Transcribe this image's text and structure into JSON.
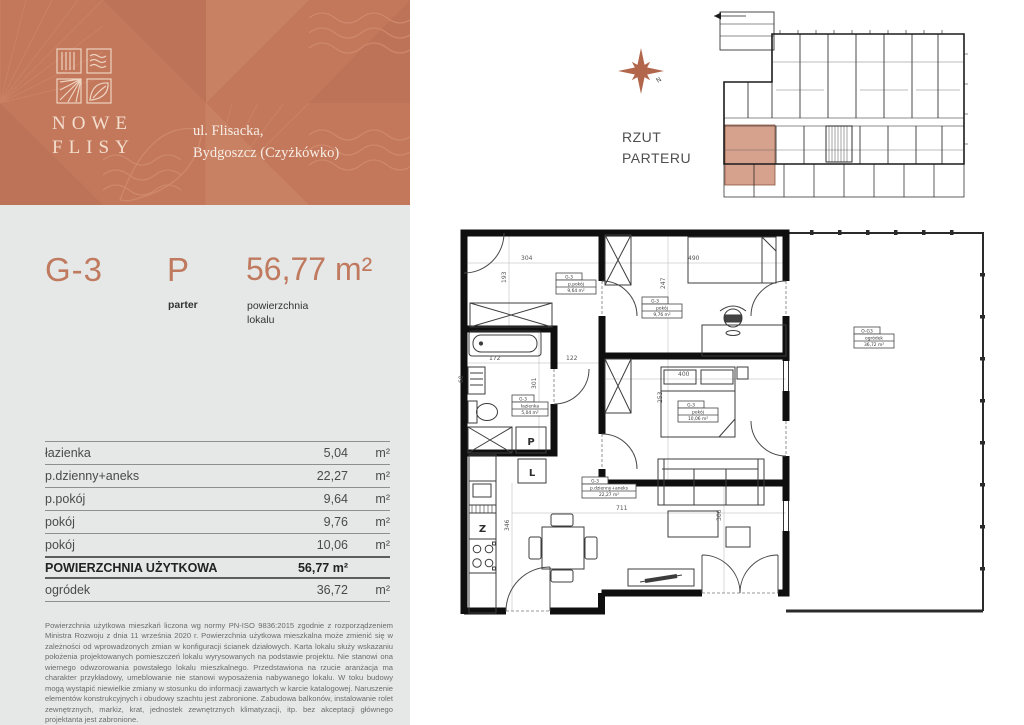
{
  "brand": {
    "name_line1": "NOWE",
    "name_line2": "FLISY",
    "address_line1": "ul. Flisacka,",
    "address_line2": "Bydgoszcz (Czyżkówko)",
    "header_bg": "#c3785c",
    "accent": "#bf7a5f"
  },
  "unit": {
    "code": "G-3",
    "floor_code": "P",
    "floor_label": "parter",
    "area": "56,77 m²",
    "area_label_line1": "powierzchnia",
    "area_label_line2": "lokalu"
  },
  "areas_table": {
    "rows": [
      {
        "name": "łazienka",
        "value": "5,04",
        "unit": "m²"
      },
      {
        "name": "p.dzienny+aneks",
        "value": "22,27",
        "unit": "m²"
      },
      {
        "name": "p.pokój",
        "value": "9,64",
        "unit": "m²"
      },
      {
        "name": "pokój",
        "value": "9,76",
        "unit": "m²"
      },
      {
        "name": "pokój",
        "value": "10,06",
        "unit": "m²"
      }
    ],
    "total": {
      "name": "POWIERZCHNIA UŻYTKOWA",
      "value": "56,77 m²"
    },
    "extra": {
      "name": "ogródek",
      "value": "36,72",
      "unit": "m²"
    }
  },
  "disclaimer": "Powierzchnia użytkowa mieszkań liczona wg normy PN-ISO 9836:2015 zgodnie z rozporządzeniem Ministra Rozwoju z dnia 11 września 2020 r. Powierzchnia użytkowa mieszkalna może zmienić się w zależności od wprowadzonych zmian w konfiguracji ścianek działowych. Karta lokalu służy wskazaniu położenia projektowanych pomieszczeń lokalu wyrysowanych na podstawie projektu. Nie stanowi ona wiernego odwzorowania powstałego lokalu mieszkalnego. Przedstawiona na rzucie aranżacja ma charakter przykładowy, umeblowanie nie stanowi wyposażenia nabywanego lokalu. W toku budowy mogą wystąpić niewielkie zmiany w stosunku do informacji zawartych w karcie katalogowej. Naruszenie elementów konstrukcyjnych i obudowy szachtu jest zabronione. Zabudowa balkonów, instalowanie rolet zewnętrznych, markiz, krat, jednostek zewnętrznych klimatyzacji, itp. bez akceptacji głównego projektanta jest zabronione.",
  "site_plan": {
    "title_line1": "RZUT",
    "title_line2": "PARTERU",
    "compass_n": "N",
    "highlight_color": "#d6a18d"
  },
  "floor_plan": {
    "rooms": [
      {
        "code": "G-3",
        "name": "p.pokój",
        "area": "9,64 m²"
      },
      {
        "code": "G-3",
        "name": "pokój",
        "area": "9,76 m²"
      },
      {
        "code": "G-3",
        "name": "pokój",
        "area": "10,06 m²"
      },
      {
        "code": "G-3",
        "name": "łazienka",
        "area": "5,04 m²"
      },
      {
        "code": "G-3",
        "name": "p.dzienny+aneks",
        "area": "22,27 m²"
      }
    ],
    "garden": {
      "code": "O-G3",
      "name": "ogródek",
      "area": "36,72 m²"
    },
    "dims": {
      "room_a_w": "304",
      "room_a_h": "193",
      "room_b_w": "490",
      "room_b_h": "247",
      "bath_w": "172",
      "hall_w": "122",
      "bath_h": "301",
      "basin_w": "60",
      "room_c_w": "400",
      "room_c_h": "253",
      "living_w": "711",
      "kitchen_h": "346",
      "living_h": "306"
    },
    "appliances": {
      "washer": "P",
      "fridge": "L",
      "dishwasher": "Z"
    }
  }
}
